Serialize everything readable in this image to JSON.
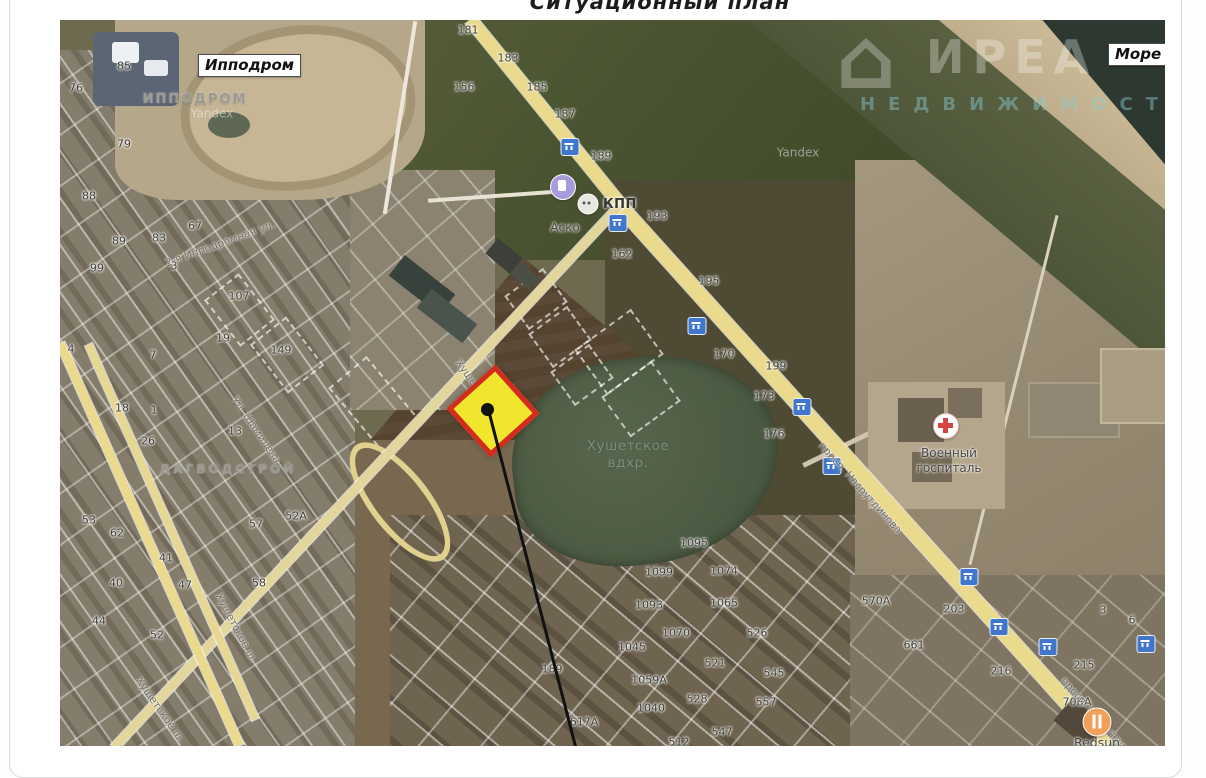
{
  "title": "Ситуационный план",
  "watermark": {
    "logo": "house-logo",
    "brand": "ИРЕА",
    "sub": "НЕДВИЖИМОСТЬ"
  },
  "callouts": [
    {
      "text": "Ипподром",
      "x": 138,
      "y": 34
    },
    {
      "text": "Море",
      "x": 1048,
      "y": 23
    }
  ],
  "labels": [
    {
      "text": "ИППОДРОМ",
      "x": 135,
      "y": 80,
      "style": "area",
      "fs": 13,
      "ls": 2
    },
    {
      "text": "ДАГВОДСТРОЙ",
      "x": 168,
      "y": 450,
      "style": "area",
      "fs": 12,
      "ls": 3
    },
    {
      "text": "Хушетское\nвдхр.",
      "x": 568,
      "y": 435,
      "style": "water",
      "fs": 13.5,
      "ls": 0.5
    },
    {
      "text": "Военный\nгоспиталь",
      "x": 889,
      "y": 441,
      "style": "poi",
      "fs": 12,
      "ls": 0
    },
    {
      "text": "Аско",
      "x": 505,
      "y": 208,
      "style": "poi",
      "fs": 12,
      "ls": 0
    },
    {
      "text": "КПП",
      "x": 560,
      "y": 185,
      "style": "poi-bold",
      "fs": 13,
      "ls": 0.5
    },
    {
      "text": "Redsun",
      "x": 1037,
      "y": 723,
      "style": "poi",
      "fs": 12.5,
      "ls": 0
    },
    {
      "text": "Yandex",
      "x": 152,
      "y": 94,
      "style": "wm",
      "fs": 12,
      "ls": 0
    },
    {
      "text": "Yandex",
      "x": 738,
      "y": 133,
      "style": "wm",
      "fs": 12,
      "ls": 0
    }
  ],
  "streets": [
    {
      "text": "Хушетское ш.",
      "x": 420,
      "y": 372,
      "r": 54
    },
    {
      "text": "Хушетское ш.",
      "x": 176,
      "y": 608,
      "r": 62
    },
    {
      "text": "Хушетское ш.",
      "x": 100,
      "y": 690,
      "r": 55
    },
    {
      "text": "просп. Насрутдинова",
      "x": 800,
      "y": 468,
      "r": 48
    },
    {
      "text": "просп. Насрутдинова",
      "x": 1042,
      "y": 703,
      "r": 48
    },
    {
      "text": "Ул. Шамилева",
      "x": 196,
      "y": 410,
      "r": 56
    },
    {
      "text": "2-я Ипподромная ул.",
      "x": 160,
      "y": 224,
      "r": -20
    }
  ],
  "numbers": [
    {
      "t": "181",
      "x": 408,
      "y": 10
    },
    {
      "t": "183",
      "x": 448,
      "y": 38
    },
    {
      "t": "156",
      "x": 404,
      "y": 67
    },
    {
      "t": "185",
      "x": 477,
      "y": 67
    },
    {
      "t": "187",
      "x": 505,
      "y": 94
    },
    {
      "t": "189",
      "x": 541,
      "y": 136
    },
    {
      "t": "193",
      "x": 597,
      "y": 196
    },
    {
      "t": "162",
      "x": 562,
      "y": 234
    },
    {
      "t": "195",
      "x": 649,
      "y": 261
    },
    {
      "t": "170",
      "x": 664,
      "y": 334
    },
    {
      "t": "199",
      "x": 716,
      "y": 346
    },
    {
      "t": "173",
      "x": 704,
      "y": 376
    },
    {
      "t": "176",
      "x": 714,
      "y": 414
    },
    {
      "t": "85",
      "x": 64,
      "y": 46
    },
    {
      "t": "76",
      "x": 16,
      "y": 68
    },
    {
      "t": "79",
      "x": 64,
      "y": 124
    },
    {
      "t": "88",
      "x": 29,
      "y": 176
    },
    {
      "t": "67",
      "x": 135,
      "y": 206
    },
    {
      "t": "89",
      "x": 59,
      "y": 221
    },
    {
      "t": "83",
      "x": 99,
      "y": 218
    },
    {
      "t": "99",
      "x": 37,
      "y": 248
    },
    {
      "t": "3",
      "x": 114,
      "y": 246
    },
    {
      "t": "107",
      "x": 179,
      "y": 276
    },
    {
      "t": "19",
      "x": 163,
      "y": 318
    },
    {
      "t": "149",
      "x": 221,
      "y": 330
    },
    {
      "t": "7",
      "x": 93,
      "y": 335
    },
    {
      "t": "4",
      "x": 11,
      "y": 329
    },
    {
      "t": "18",
      "x": 62,
      "y": 388
    },
    {
      "t": "1",
      "x": 94,
      "y": 390
    },
    {
      "t": "26",
      "x": 88,
      "y": 421
    },
    {
      "t": "13",
      "x": 175,
      "y": 411
    },
    {
      "t": "57",
      "x": 196,
      "y": 504
    },
    {
      "t": "52А",
      "x": 236,
      "y": 496
    },
    {
      "t": "53",
      "x": 29,
      "y": 500
    },
    {
      "t": "62",
      "x": 57,
      "y": 513
    },
    {
      "t": "41",
      "x": 106,
      "y": 538
    },
    {
      "t": "40",
      "x": 56,
      "y": 563
    },
    {
      "t": "47",
      "x": 125,
      "y": 565
    },
    {
      "t": "58",
      "x": 199,
      "y": 563
    },
    {
      "t": "44",
      "x": 39,
      "y": 601
    },
    {
      "t": "52",
      "x": 97,
      "y": 615
    },
    {
      "t": "1095",
      "x": 634,
      "y": 523
    },
    {
      "t": "1099",
      "x": 599,
      "y": 552
    },
    {
      "t": "1074",
      "x": 664,
      "y": 551
    },
    {
      "t": "1093",
      "x": 589,
      "y": 585
    },
    {
      "t": "1065",
      "x": 664,
      "y": 583
    },
    {
      "t": "526",
      "x": 697,
      "y": 613
    },
    {
      "t": "1070",
      "x": 616,
      "y": 613
    },
    {
      "t": "1045",
      "x": 572,
      "y": 627
    },
    {
      "t": "521",
      "x": 655,
      "y": 643
    },
    {
      "t": "545",
      "x": 714,
      "y": 653
    },
    {
      "t": "1059А",
      "x": 589,
      "y": 660
    },
    {
      "t": "528",
      "x": 637,
      "y": 679
    },
    {
      "t": "557",
      "x": 706,
      "y": 682
    },
    {
      "t": "1040",
      "x": 591,
      "y": 688
    },
    {
      "t": "547",
      "x": 662,
      "y": 712
    },
    {
      "t": "512",
      "x": 619,
      "y": 722
    },
    {
      "t": "617А",
      "x": 524,
      "y": 702
    },
    {
      "t": "189",
      "x": 492,
      "y": 649
    },
    {
      "t": "570А",
      "x": 816,
      "y": 581
    },
    {
      "t": "203",
      "x": 894,
      "y": 589
    },
    {
      "t": "661",
      "x": 854,
      "y": 625
    },
    {
      "t": "216",
      "x": 941,
      "y": 651
    },
    {
      "t": "215",
      "x": 1024,
      "y": 645
    },
    {
      "t": "3",
      "x": 1043,
      "y": 590
    },
    {
      "t": "6",
      "x": 1072,
      "y": 600
    },
    {
      "t": "70ВА",
      "x": 1017,
      "y": 682
    }
  ],
  "shields": [
    {
      "x": 510,
      "y": 127
    },
    {
      "x": 558,
      "y": 203
    },
    {
      "x": 637,
      "y": 306
    },
    {
      "x": 742,
      "y": 387
    },
    {
      "x": 772,
      "y": 446
    },
    {
      "x": 909,
      "y": 557
    },
    {
      "x": 939,
      "y": 607
    },
    {
      "x": 988,
      "y": 627
    },
    {
      "x": 1086,
      "y": 624
    }
  ],
  "parcels": [
    {
      "x": 272,
      "y": 360,
      "w": 82,
      "h": 46,
      "r": 50
    },
    {
      "x": 150,
      "y": 268,
      "w": 55,
      "h": 40,
      "r": 52
    },
    {
      "x": 196,
      "y": 312,
      "w": 58,
      "h": 42,
      "r": 52
    },
    {
      "x": 452,
      "y": 258,
      "w": 44,
      "h": 38,
      "r": -36
    },
    {
      "x": 476,
      "y": 296,
      "w": 44,
      "h": 38,
      "r": -36
    },
    {
      "x": 498,
      "y": 334,
      "w": 44,
      "h": 38,
      "r": -36
    },
    {
      "x": 524,
      "y": 304,
      "w": 66,
      "h": 52,
      "r": -36
    },
    {
      "x": 550,
      "y": 354,
      "w": 58,
      "h": 46,
      "r": -36
    }
  ]
}
